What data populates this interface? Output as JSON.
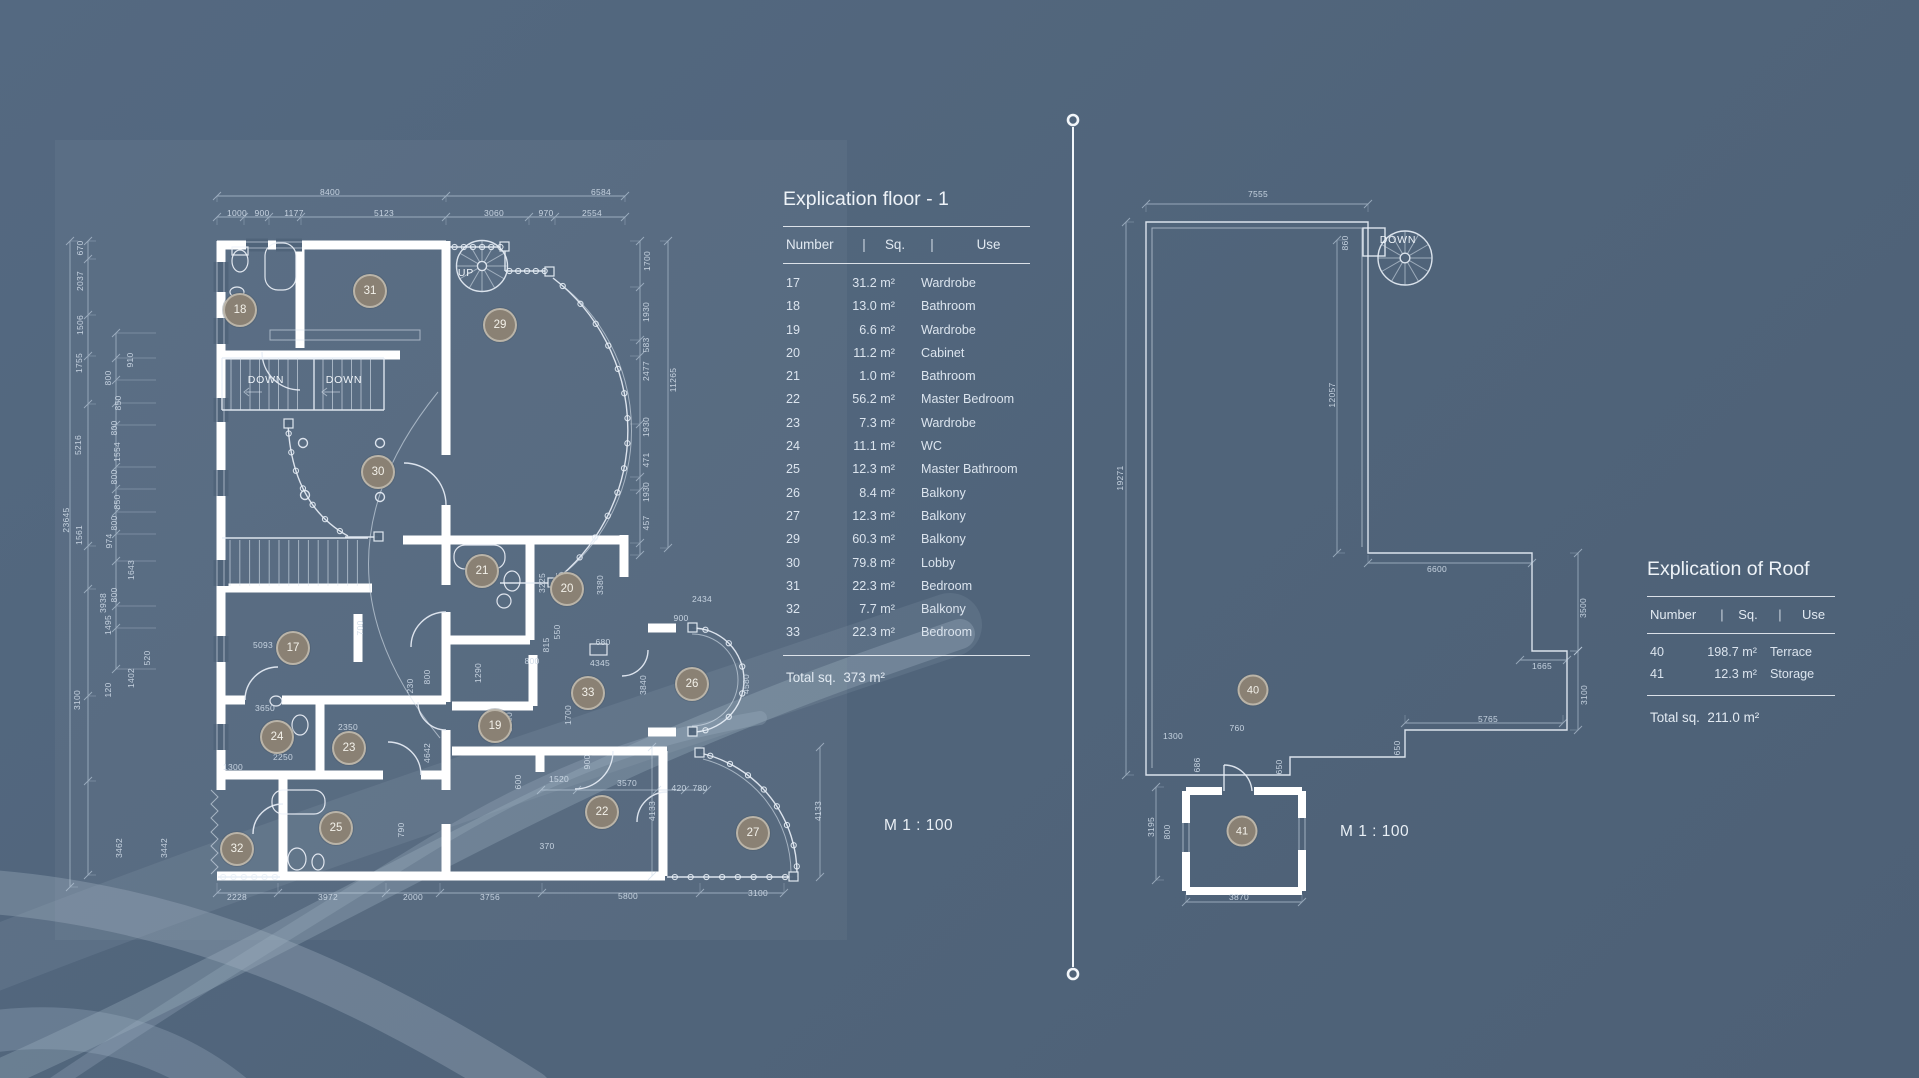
{
  "colors": {
    "background": "#50647a",
    "panel": "rgba(255,255,255,0.045)",
    "wall": "#ffffff",
    "thin_line": "#e7eef6",
    "dim_text": "#cdd9e6",
    "badge_fill": "#8a8174",
    "badge_border": "rgba(226,222,212,0.55)",
    "badge_text": "#f3f1ea",
    "table_text": "#dbe4ee",
    "watermark": "#a7b8c8"
  },
  "floor_explication": {
    "title": "Explication floor - 1",
    "columns": [
      "Number",
      "Sq.",
      "Use"
    ],
    "separator": "|",
    "rows": [
      [
        "17",
        "31.2 m²",
        "Wardrobe"
      ],
      [
        "18",
        "13.0 m²",
        "Bathroom"
      ],
      [
        "19",
        "6.6 m²",
        "Wardrobe"
      ],
      [
        "20",
        "11.2 m²",
        "Cabinet"
      ],
      [
        "21",
        "1.0 m²",
        "Bathroom"
      ],
      [
        "22",
        "56.2 m²",
        "Master Bedroom"
      ],
      [
        "23",
        "7.3 m²",
        "Wardrobe"
      ],
      [
        "24",
        "11.1 m²",
        "WC"
      ],
      [
        "25",
        "12.3 m²",
        "Master Bathroom"
      ],
      [
        "26",
        "8.4 m²",
        "Balkony"
      ],
      [
        "27",
        "12.3 m²",
        "Balkony"
      ],
      [
        "29",
        "60.3 m²",
        "Balkony"
      ],
      [
        "30",
        "79.8 m²",
        "Lobby"
      ],
      [
        "31",
        "22.3 m²",
        "Bedroom"
      ],
      [
        "32",
        "7.7 m²",
        "Balkony"
      ],
      [
        "33",
        "22.3 m²",
        "Bedroom"
      ]
    ],
    "total_label": "Total sq.",
    "total_value": "373 m²"
  },
  "roof_explication": {
    "title": "Explication of Roof",
    "columns": [
      "Number",
      "Sq.",
      "Use"
    ],
    "separator": "|",
    "rows": [
      [
        "40",
        "198.7 m²",
        "Terrace"
      ],
      [
        "41",
        "12.3 m²",
        "Storage"
      ]
    ],
    "total_label": "Total sq.",
    "total_value": "211.0 m²"
  },
  "scale_floor": "M 1 : 100",
  "scale_roof": "M 1 : 100",
  "floor_plan": {
    "labels": [
      {
        "text": "UP",
        "x": 466,
        "y": 273
      },
      {
        "text": "DOWN",
        "x": 266,
        "y": 380
      },
      {
        "text": "DOWN",
        "x": 344,
        "y": 380
      }
    ],
    "badges": [
      {
        "n": "17",
        "x": 293,
        "y": 648
      },
      {
        "n": "18",
        "x": 240,
        "y": 310
      },
      {
        "n": "19",
        "x": 495,
        "y": 726
      },
      {
        "n": "20",
        "x": 567,
        "y": 589
      },
      {
        "n": "21",
        "x": 482,
        "y": 571
      },
      {
        "n": "22",
        "x": 602,
        "y": 812
      },
      {
        "n": "23",
        "x": 349,
        "y": 748
      },
      {
        "n": "24",
        "x": 277,
        "y": 737
      },
      {
        "n": "25",
        "x": 336,
        "y": 828
      },
      {
        "n": "26",
        "x": 692,
        "y": 684
      },
      {
        "n": "27",
        "x": 753,
        "y": 833
      },
      {
        "n": "29",
        "x": 500,
        "y": 325
      },
      {
        "n": "30",
        "x": 378,
        "y": 472
      },
      {
        "n": "31",
        "x": 370,
        "y": 291
      },
      {
        "n": "32",
        "x": 237,
        "y": 849
      },
      {
        "n": "33",
        "x": 588,
        "y": 693
      }
    ],
    "dimensions": [
      [
        "8400",
        330,
        192,
        0
      ],
      [
        "6584",
        601,
        192,
        0
      ],
      [
        "1000",
        237,
        213,
        0
      ],
      [
        "900",
        262,
        213,
        0
      ],
      [
        "1177",
        294,
        213,
        0
      ],
      [
        "5123",
        384,
        213,
        0
      ],
      [
        "3060",
        494,
        213,
        0
      ],
      [
        "970",
        546,
        213,
        0
      ],
      [
        "2554",
        592,
        213,
        0
      ],
      [
        "1700",
        647,
        261,
        1
      ],
      [
        "1930",
        646,
        312,
        1
      ],
      [
        "583",
        646,
        345,
        1
      ],
      [
        "2477",
        646,
        371,
        1
      ],
      [
        "11265",
        673,
        380,
        1
      ],
      [
        "1930",
        646,
        427,
        1
      ],
      [
        "471",
        646,
        460,
        1
      ],
      [
        "1930",
        646,
        492,
        1
      ],
      [
        "457",
        646,
        523,
        1
      ],
      [
        "23645",
        66,
        520,
        1
      ],
      [
        "670",
        80,
        248,
        1
      ],
      [
        "2037",
        80,
        281,
        1
      ],
      [
        "1506",
        80,
        325,
        1
      ],
      [
        "1755",
        79,
        363,
        1
      ],
      [
        "5216",
        78,
        445,
        1
      ],
      [
        "1561",
        79,
        535,
        1
      ],
      [
        "3938",
        103,
        603,
        1
      ],
      [
        "3100",
        77,
        700,
        1
      ],
      [
        "3462",
        119,
        848,
        1
      ],
      [
        "3442",
        164,
        848,
        1
      ],
      [
        "910",
        130,
        360,
        1
      ],
      [
        "800",
        108,
        378,
        1
      ],
      [
        "850",
        118,
        403,
        1
      ],
      [
        "800",
        114,
        428,
        1
      ],
      [
        "1554",
        117,
        452,
        1
      ],
      [
        "800",
        114,
        477,
        1
      ],
      [
        "850",
        117,
        502,
        1
      ],
      [
        "800",
        114,
        523,
        1
      ],
      [
        "974",
        109,
        541,
        1
      ],
      [
        "1643",
        131,
        570,
        1
      ],
      [
        "800",
        114,
        595,
        1
      ],
      [
        "1495",
        108,
        625,
        1
      ],
      [
        "520",
        147,
        658,
        1
      ],
      [
        "1402",
        131,
        678,
        1
      ],
      [
        "120",
        108,
        690,
        1
      ],
      [
        "5093",
        263,
        645,
        0
      ],
      [
        "700",
        360,
        628,
        1
      ],
      [
        "3650",
        265,
        708,
        0
      ],
      [
        "2350",
        348,
        727,
        0
      ],
      [
        "2250",
        283,
        757,
        0
      ],
      [
        "1300",
        233,
        767,
        0
      ],
      [
        "4642",
        427,
        753,
        1
      ],
      [
        "230",
        410,
        686,
        1
      ],
      [
        "800",
        427,
        677,
        1
      ],
      [
        "1290",
        478,
        673,
        1
      ],
      [
        "790",
        401,
        830,
        1
      ],
      [
        "1900",
        509,
        722,
        1
      ],
      [
        "600",
        518,
        782,
        1
      ],
      [
        "1520",
        559,
        779,
        0
      ],
      [
        "3570",
        627,
        783,
        0
      ],
      [
        "420",
        679,
        788,
        0
      ],
      [
        "780",
        700,
        788,
        0
      ],
      [
        "900",
        587,
        762,
        1
      ],
      [
        "370",
        547,
        846,
        0
      ],
      [
        "3225",
        542,
        583,
        1
      ],
      [
        "3345",
        559,
        582,
        1
      ],
      [
        "3380",
        600,
        585,
        1
      ],
      [
        "550",
        557,
        632,
        1
      ],
      [
        "815",
        546,
        645,
        1
      ],
      [
        "680",
        603,
        642,
        0
      ],
      [
        "800",
        532,
        661,
        0
      ],
      [
        "4345",
        600,
        663,
        0
      ],
      [
        "3840",
        643,
        685,
        1
      ],
      [
        "1700",
        568,
        715,
        1
      ],
      [
        "2434",
        702,
        599,
        0
      ],
      [
        "900",
        681,
        618,
        0
      ],
      [
        "4580",
        746,
        684,
        1
      ],
      [
        "4133",
        652,
        811,
        1
      ],
      [
        "4133",
        818,
        811,
        1
      ],
      [
        "2228",
        237,
        897,
        0
      ],
      [
        "3972",
        328,
        897,
        0
      ],
      [
        "2000",
        413,
        897,
        0
      ],
      [
        "3756",
        490,
        897,
        0
      ],
      [
        "5800",
        628,
        896,
        0
      ],
      [
        "3100",
        758,
        893,
        0
      ]
    ]
  },
  "roof_plan": {
    "labels": [
      {
        "text": "DOWN",
        "x": 1398,
        "y": 240
      }
    ],
    "badges": [
      {
        "n": "40",
        "x": 1253,
        "y": 690
      },
      {
        "n": "41",
        "x": 1242,
        "y": 831
      }
    ],
    "dimensions": [
      [
        "7555",
        1258,
        194,
        0
      ],
      [
        "860",
        1345,
        243,
        1
      ],
      [
        "12057",
        1332,
        395,
        1
      ],
      [
        "19271",
        1120,
        478,
        1
      ],
      [
        "6600",
        1437,
        569,
        0
      ],
      [
        "3500",
        1583,
        608,
        1
      ],
      [
        "1665",
        1542,
        666,
        0
      ],
      [
        "3100",
        1584,
        695,
        1
      ],
      [
        "5765",
        1488,
        719,
        0
      ],
      [
        "650",
        1397,
        748,
        1
      ],
      [
        "650",
        1279,
        767,
        1
      ],
      [
        "1300",
        1173,
        736,
        0
      ],
      [
        "760",
        1237,
        728,
        0
      ],
      [
        "686",
        1197,
        765,
        1
      ],
      [
        "3195",
        1151,
        827,
        1
      ],
      [
        "800",
        1167,
        832,
        1
      ],
      [
        "3870",
        1239,
        897,
        0
      ]
    ]
  }
}
